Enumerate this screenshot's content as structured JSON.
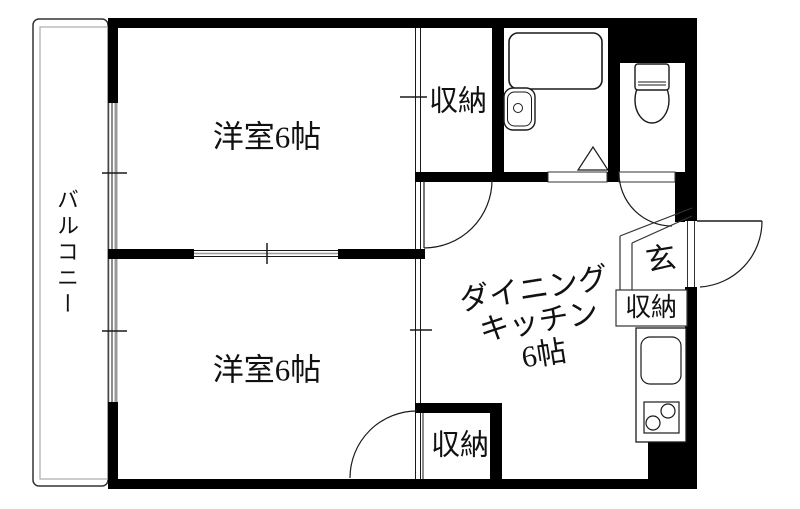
{
  "plan": {
    "balcony_label": "バルコニー",
    "room_top_label": "洋室6帖",
    "room_bottom_label": "洋室6帖",
    "dk_line1": "ダイニング",
    "dk_line2": "キッチン",
    "dk_line3": "6帖",
    "closet_top_label": "収納",
    "closet_bottom_label": "収納",
    "entry_closet_label": "収納",
    "entrance_label": "玄",
    "fixture_icons": [
      "bathtub-icon",
      "washbasin-icon",
      "shower-door-icon",
      "toilet-icon",
      "kitchen-sink-icon",
      "stove-icon"
    ],
    "colors": {
      "wall": "#000000",
      "outline": "#1a1a1a",
      "window_gray": "#999999",
      "balcony_inner_gray": "#aaaaaa",
      "background": "#ffffff"
    }
  }
}
